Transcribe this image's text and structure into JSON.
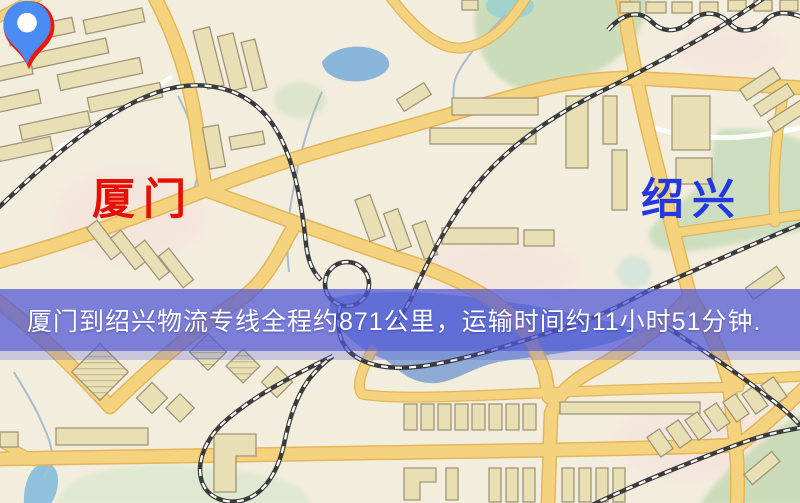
{
  "banner": {
    "text": "厦门到绍兴物流专线全程约871公里，运输时间约11小时51分钟.",
    "background_color": "#5158d7",
    "text_color": "#ffffff"
  },
  "markers": {
    "origin": {
      "label": "厦门",
      "icon": "red-map-pin-icon",
      "pin_color": "#f11607",
      "label_color": "#e60f00"
    },
    "destination": {
      "label": "绍兴",
      "icon": "blue-map-pin-icon",
      "pin_color": "#4a8cf3",
      "label_color": "#2438e2"
    }
  },
  "route_facts": {
    "distance_km": 871,
    "duration_hours": 11,
    "duration_minutes": 51
  },
  "map_colors": {
    "background": "#f3eddd",
    "road_fill": "#f5d27d",
    "road_border": "#e2b65b",
    "water": "#8ab5da",
    "park_green": "#cddec0",
    "railway": "#3b3b3b",
    "building_fill": "#e9dfb4"
  }
}
